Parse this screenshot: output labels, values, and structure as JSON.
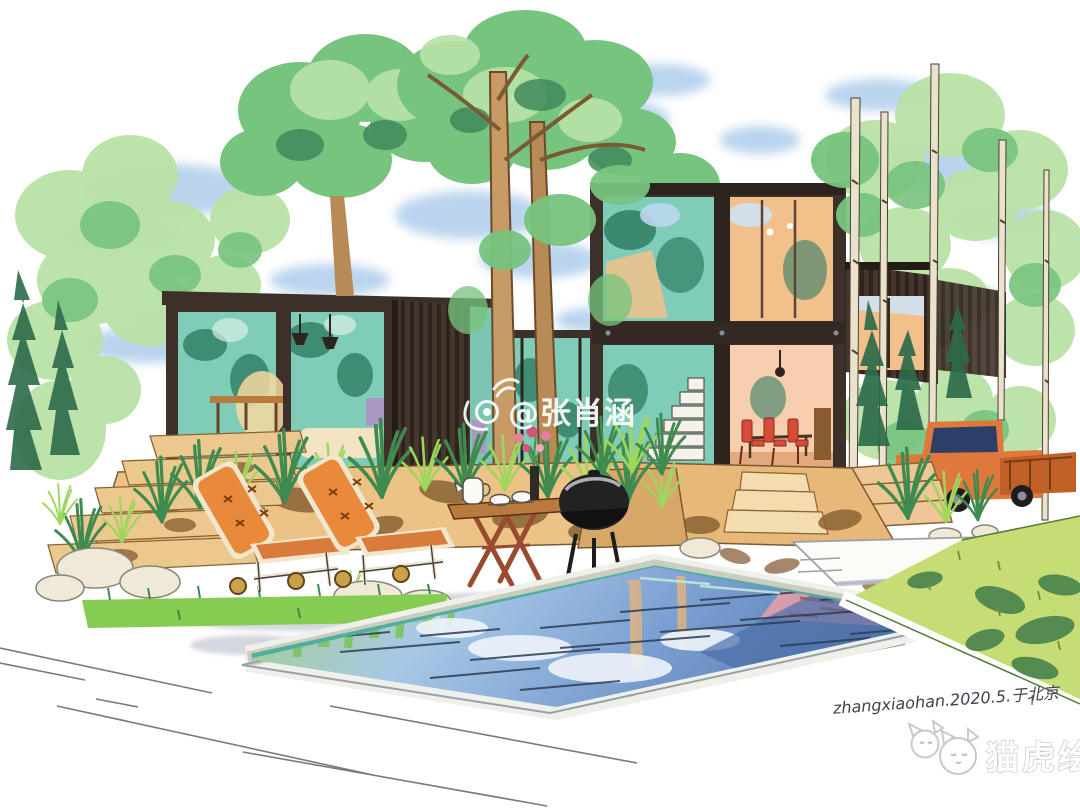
{
  "watermark": {
    "icon": "weibo-eye-icon",
    "handle": "@张肖涵",
    "color": "#ffffff"
  },
  "signature": {
    "text": "zhangxiaohan.2020.5.于北京",
    "color": "#3f414d"
  },
  "logo": {
    "icon": "two-cat-faces-icon",
    "text": "猫虎绘",
    "color": "#ffffff",
    "outline": "#c6c6c6"
  },
  "palette": {
    "paper": "#ffffff",
    "sky": "#aecdeb",
    "foliage_light": "#b9e2a6",
    "foliage_mid": "#77c47e",
    "foliage_dark": "#3f8a5c",
    "foliage_deep": "#2c6b4a",
    "trunk": "#c79a66",
    "birch": "#ebe2cd",
    "container_dark": "#3d3029",
    "glass_teal": "#7fcdb9",
    "glass_teal_deep": "#2f7d62",
    "interior_warm": "#f2c08a",
    "interior_peach": "#f7cfae",
    "chair_red": "#d84b38",
    "cushion_orange": "#e8893c",
    "wood": "#b97a3e",
    "leg_red": "#9a4a2e",
    "terrace_tan": "#ecc287",
    "terrace_shadow": "#8a6434",
    "pool_blue": "#8fb3de",
    "pool_deep": "#4a6fa8",
    "pool_rim_teal": "#4fae9e",
    "reflection_green": "#7cc45e",
    "reflection_pink": "#e8a0a8",
    "lawn": "#c6dc74",
    "lawn_shadow": "#3f7d4a",
    "truck_orange": "#e0783c",
    "grill_black": "#222222",
    "stone": "#efe9d8",
    "shadow_gray": "#b9bdc9",
    "ink": "#2e2a26"
  }
}
